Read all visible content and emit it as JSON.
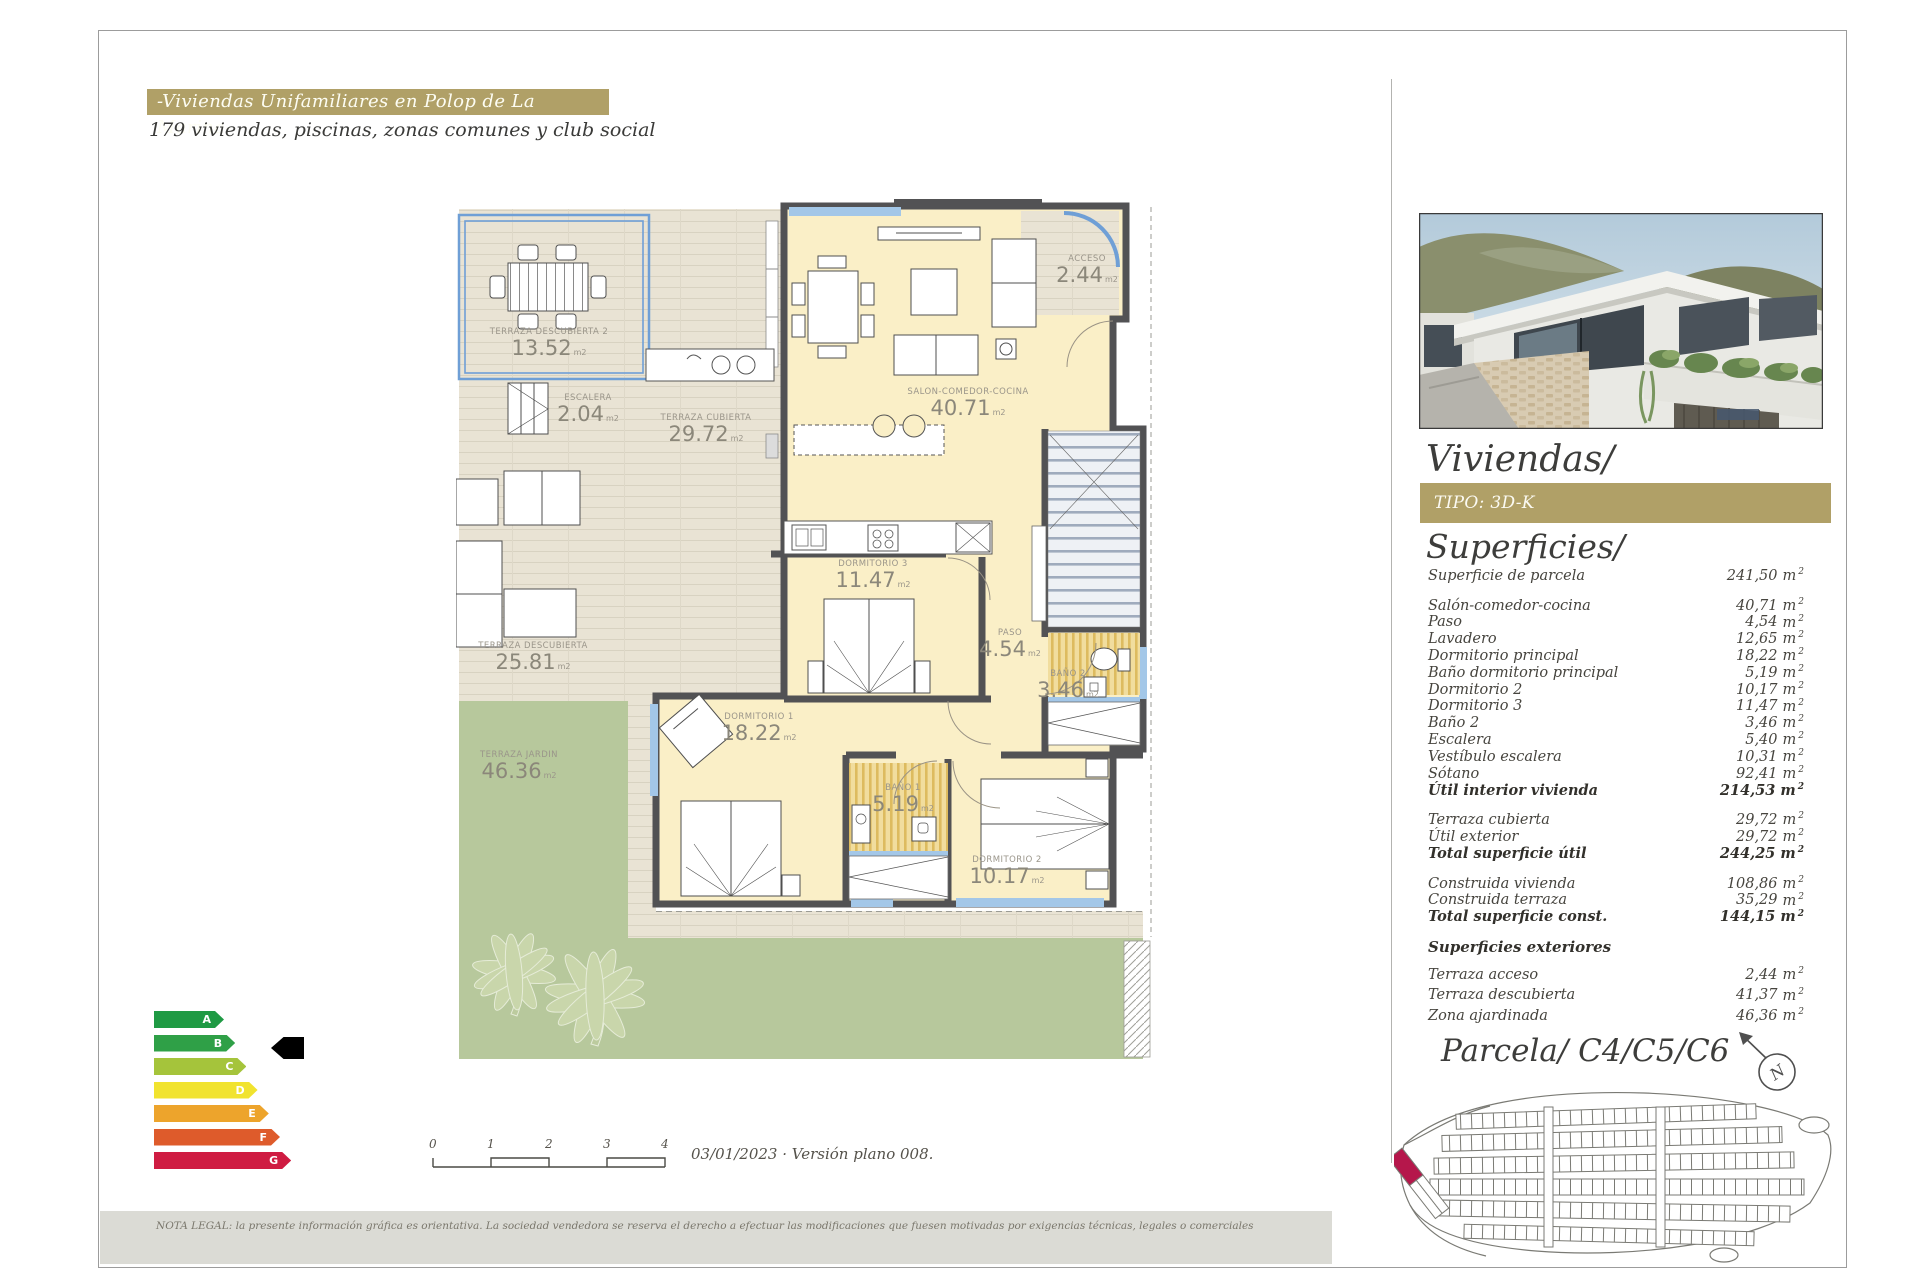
{
  "header": {
    "title": "-Viviendas Unifamiliares en Polop de La Marina-",
    "subtitle": "179 viviendas, piscinas, zonas comunes y club social"
  },
  "floorplan": {
    "unit": "m2",
    "rooms": [
      {
        "id": "terraza-descubierta-2",
        "name": "TERRAZA DESCUBIERTA 2",
        "area": "13.52"
      },
      {
        "id": "escalera",
        "name": "ESCALERA",
        "area": "2.04"
      },
      {
        "id": "terraza-cubierta",
        "name": "TERRAZA CUBIERTA",
        "area": "29.72"
      },
      {
        "id": "salon-comedor-cocina",
        "name": "SALON-COMEDOR-COCINA",
        "area": "40.71"
      },
      {
        "id": "acceso",
        "name": "ACCESO",
        "area": "2.44"
      },
      {
        "id": "dormitorio-3",
        "name": "DORMITORIO 3",
        "area": "11.47"
      },
      {
        "id": "paso",
        "name": "PASO",
        "area": "4.54"
      },
      {
        "id": "bano-2",
        "name": "BAÑO 2",
        "area": "3.46"
      },
      {
        "id": "dormitorio-1",
        "name": "DORMITORIO 1",
        "area": "18.22"
      },
      {
        "id": "bano-1",
        "name": "BAÑO 1",
        "area": "5.19"
      },
      {
        "id": "dormitorio-2",
        "name": "DORMITORIO 2",
        "area": "10.17"
      },
      {
        "id": "terraza-descubierta",
        "name": "TERRAZA DESCUBIERTA",
        "area": "25.81"
      },
      {
        "id": "terraza-jardin",
        "name": "TERRAZA JARDIN",
        "area": "46.36"
      }
    ]
  },
  "energy": {
    "selected": "B",
    "grades": [
      {
        "letter": "A",
        "color": "#1f9a44"
      },
      {
        "letter": "B",
        "color": "#2fa047"
      },
      {
        "letter": "C",
        "color": "#a5c43b"
      },
      {
        "letter": "D",
        "color": "#f1e32f"
      },
      {
        "letter": "E",
        "color": "#eda42c"
      },
      {
        "letter": "F",
        "color": "#de5b2b"
      },
      {
        "letter": "G",
        "color": "#cf1c42"
      }
    ]
  },
  "scalebar": {
    "ticks": [
      "0",
      "1",
      "2",
      "3",
      "4"
    ]
  },
  "version_note": "03/01/2023 · Versión plano 008.",
  "sidebar": {
    "project_title": "Viviendas/",
    "tipo_label": "TIPO: 3D-K",
    "parcela_title": "Parcela/ C4/C5/C6",
    "compass_letter": "N"
  },
  "superficies": {
    "title": "Superficies/",
    "unit": "m",
    "unit_sup": "2",
    "groups": [
      {
        "rows": [
          {
            "label": "Superficie de parcela",
            "value": "241,50",
            "bold": false
          }
        ]
      },
      {
        "rows": [
          {
            "label": "Salón-comedor-cocina",
            "value": "40,71",
            "bold": false
          },
          {
            "label": "Paso",
            "value": "4,54",
            "bold": false
          },
          {
            "label": "Lavadero",
            "value": "12,65",
            "bold": false
          },
          {
            "label": "Dormitorio principal",
            "value": "18,22",
            "bold": false
          },
          {
            "label": "Baño dormitorio principal",
            "value": "5,19",
            "bold": false
          },
          {
            "label": "Dormitorio 2",
            "value": "10,17",
            "bold": false
          },
          {
            "label": "Dormitorio 3",
            "value": "11,47",
            "bold": false
          },
          {
            "label": "Baño 2",
            "value": "3,46",
            "bold": false
          },
          {
            "label": "Escalera",
            "value": "5,40",
            "bold": false
          },
          {
            "label": "Vestíbulo escalera",
            "value": "10,31",
            "bold": false
          },
          {
            "label": "Sótano",
            "value": "92,41",
            "bold": false
          },
          {
            "label": "Útil interior vivienda",
            "value": "214,53",
            "bold": true
          }
        ]
      },
      {
        "rows": [
          {
            "label": "Terraza cubierta",
            "value": "29,72",
            "bold": false
          },
          {
            "label": "Útil exterior",
            "value": "29,72",
            "bold": false
          },
          {
            "label": "Total superficie útil",
            "value": "244,25",
            "bold": true
          }
        ]
      },
      {
        "rows": [
          {
            "label": "Construida vivienda",
            "value": "108,86",
            "bold": false
          },
          {
            "label": "Construida terraza",
            "value": "35,29",
            "bold": false
          },
          {
            "label": "Total superficie const.",
            "value": "144,15",
            "bold": true
          }
        ]
      },
      {
        "header": "Superficies exteriores",
        "rows": [
          {
            "label": "Terraza acceso",
            "value": "2,44",
            "bold": false
          },
          {
            "label": "Terraza descubierta",
            "value": "41,37",
            "bold": false
          },
          {
            "label": "Zona ajardinada",
            "value": "46,36",
            "bold": false
          }
        ]
      }
    ]
  },
  "legal_note": "NOTA LEGAL: la presente información gráfica es orientativa. La sociedad vendedora se reserva el derecho a efectuar las modificaciones que fuesen motivadas por exigencias técnicas, legales o comerciales"
}
